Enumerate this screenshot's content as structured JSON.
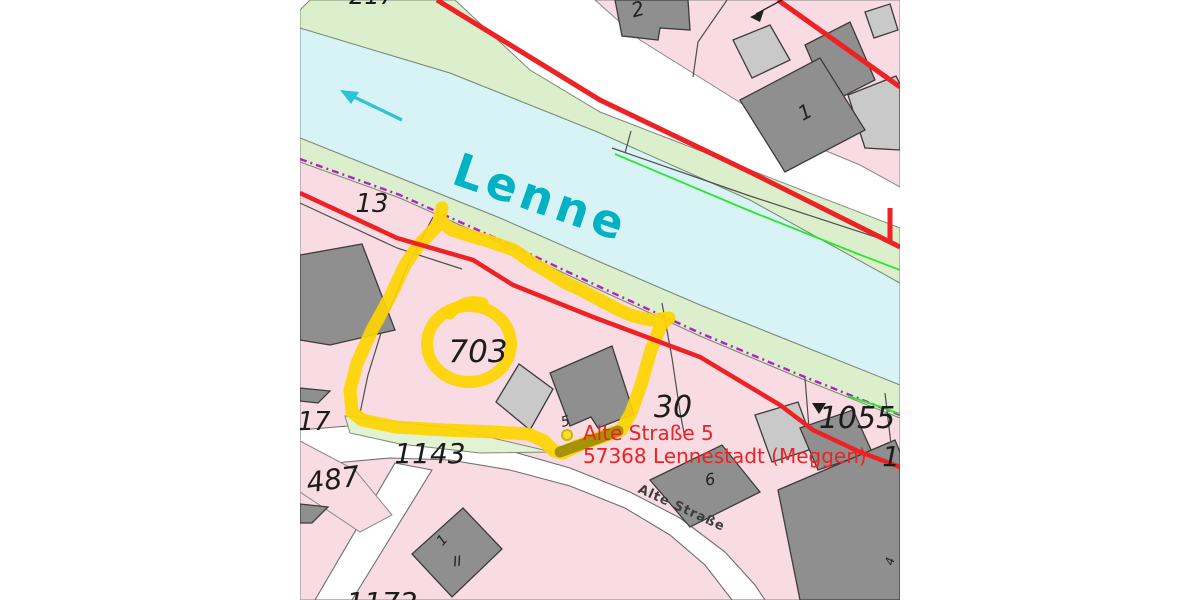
{
  "river": {
    "name": "Lenne"
  },
  "address": {
    "line1": "Alte Straße 5",
    "line2": "57368 Lennestadt (Meggen)"
  },
  "street": {
    "name": "Alte Straße"
  },
  "parcels": {
    "p703": "703",
    "p13": "13",
    "p30": "30",
    "p1055": "1055",
    "p1143": "1143",
    "p17": "17",
    "p487": "487",
    "p1172": "1172",
    "p217": "217",
    "p13r": "13"
  },
  "houses": {
    "h1": "1",
    "h2": "2",
    "h5": "5",
    "h6": "6",
    "hd1": "1",
    "storeys": "II",
    "h4": "4"
  },
  "colors": {
    "highlight_yellow": "#fdd403",
    "boundary_red": "#ee2125",
    "river_cyan": "#d8f3f6",
    "bank_green": "#dcefcc",
    "parcel_pink": "#f9dbe3",
    "building_dark": "#8f8f8f",
    "building_light": "#c9c9c9",
    "river_label_teal": "#00b2c4",
    "address_red": "#ee2222",
    "protected_purple": "#b81ec8",
    "flow_arrow_cyan": "#29c5d2"
  }
}
